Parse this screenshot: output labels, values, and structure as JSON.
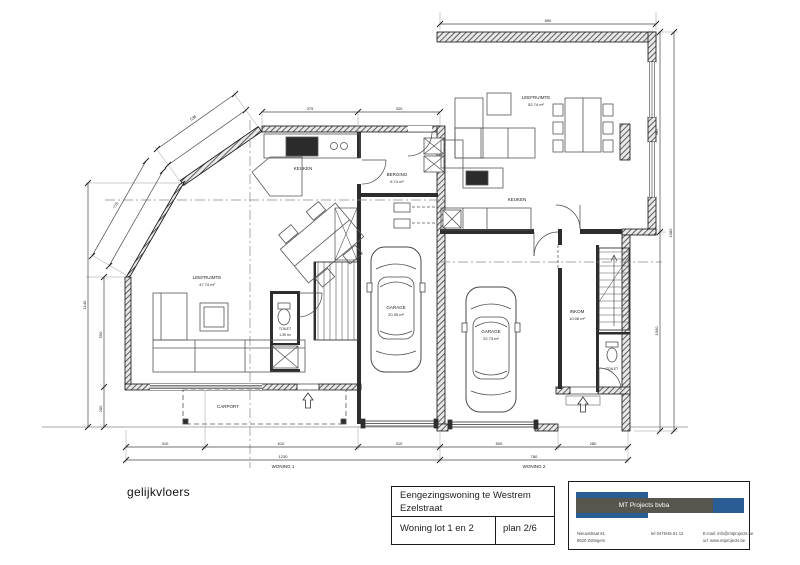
{
  "sheet": {
    "floor_label": "gelijkvloers"
  },
  "title_block": {
    "project_line1": "Eengezingswoning te Westrem",
    "project_line2": "Ezelstraat",
    "lot": "Woning lot 1 en 2",
    "plan_no": "plan 2/6"
  },
  "company": {
    "name": "MT Projects bvba",
    "address_line1": "Nieuwstraat 81",
    "address_line2": "9620 Zottegem",
    "phone": "tel 0476/45 61 12",
    "email": "E-mail: info@mtprojects.be",
    "website": "url: www.mtprojects.be",
    "brand_blue": "#2a5d94",
    "brand_gray": "#57564e"
  },
  "rooms": {
    "leefruimte1": {
      "name": "LEEFRUIMTE",
      "area": "47.74 m²"
    },
    "keuken1": {
      "name": "KEUKEN"
    },
    "toilet1": {
      "name": "TOILET",
      "area": "1.35 m²"
    },
    "berging": {
      "name": "BERGING",
      "area": "6.74 m²"
    },
    "garage1": {
      "name": "GARAGE",
      "area": "20.35 m²"
    },
    "carport": {
      "name": "CARPORT"
    },
    "leefruimte2": {
      "name": "LEEFRUIMTE",
      "area": "52.74 m²"
    },
    "keuken2": {
      "name": "KEUKEN"
    },
    "garage2": {
      "name": "GARAGE",
      "area": "22.73 m²"
    },
    "inkom": {
      "name": "INKOM",
      "area": "10.06 m²"
    },
    "toilet2": {
      "name": "TOILET"
    }
  },
  "dims": {
    "w1_total": "1230",
    "w1_name": "WONING 1",
    "w2_total": "780",
    "w2_name": "WONING 2",
    "b1": "310",
    "b2": "610",
    "b3": "310",
    "b4": "500",
    "b5": "280",
    "lt1": "375",
    "lt2": "320",
    "t_total": "890",
    "r1": "985",
    "r2": "1000",
    "r_total": "1985",
    "l1": "550",
    "l2": "200",
    "l_total": "1140",
    "dA": "536",
    "dB": "775"
  }
}
